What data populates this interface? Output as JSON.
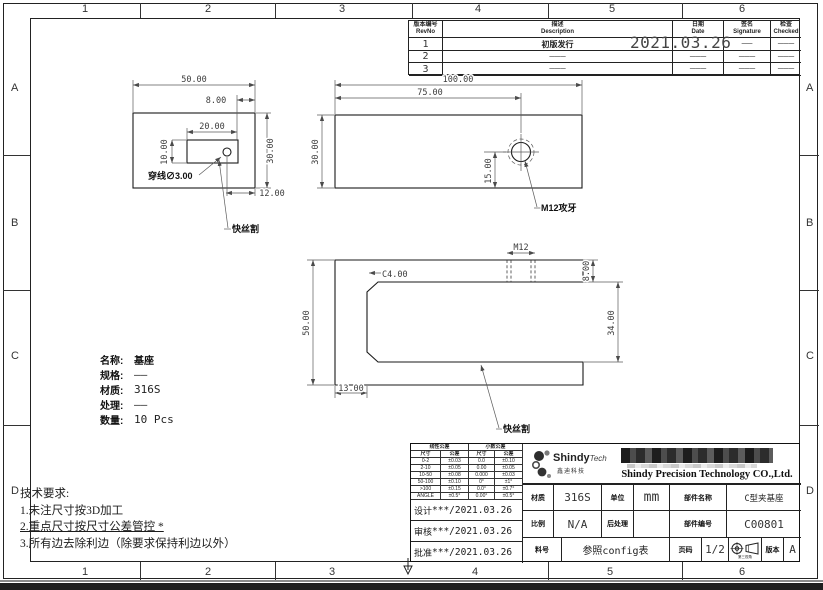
{
  "frame": {
    "columns": [
      "1",
      "2",
      "3",
      "4",
      "5",
      "6"
    ],
    "rows": [
      "A",
      "B",
      "C",
      "D"
    ]
  },
  "revision_table": {
    "headers": [
      {
        "cn": "版本编号",
        "en": "RevNo"
      },
      {
        "cn": "描述",
        "en": "Description"
      },
      {
        "cn": "日期",
        "en": "Date"
      },
      {
        "cn": "签名",
        "en": "Signature"
      },
      {
        "cn": "检查",
        "en": "Checked"
      }
    ],
    "rows": [
      {
        "no": "1",
        "desc": "初版发行",
        "date": "2021.03.26",
        "sig": "——",
        "chk": "———"
      },
      {
        "no": "2",
        "desc": "———",
        "date": "———",
        "sig": "———",
        "chk": "———"
      },
      {
        "no": "3",
        "desc": "———",
        "date": "———",
        "sig": "———",
        "chk": "———"
      }
    ]
  },
  "views": {
    "view1": {
      "dim_width": "50.00",
      "dim_8": "8.00",
      "dim_20": "20.00",
      "dim_10": "10.00",
      "dim_30": "30.00",
      "dim_12": "12.00",
      "label_hole": "穿线∅3.00",
      "label_wirecut": "快丝割"
    },
    "view2": {
      "dim_100": "100.00",
      "dim_75": "75.00",
      "dim_30": "30.00",
      "dim_15": "15.00",
      "label_tap": "M12攻牙"
    },
    "view3": {
      "dim_m12": "M12",
      "dim_c4": "C4.00",
      "dim_50": "50.00",
      "dim_13": "13.00",
      "dim_8": "8.00",
      "dim_34": "34.00",
      "label_wirecut": "快丝割"
    }
  },
  "part_info": {
    "rows": [
      {
        "label": "名称:",
        "value": "基座"
      },
      {
        "label": "规格:",
        "value": "——"
      },
      {
        "label": "材质:",
        "value": "316S"
      },
      {
        "label": "处理:",
        "value": "——"
      },
      {
        "label": "数量:",
        "value": "10 Pcs"
      }
    ]
  },
  "tech_requirements": {
    "title": "技术要求:",
    "items": [
      "1.未注尺寸按3D加工",
      "2.重点尺寸按尺寸公差管控 *",
      "3.所有边去除利边（除要求保持利边以外）"
    ]
  },
  "title_block": {
    "tolerance_table": {
      "group1": "线性公差",
      "group2": "小数公差",
      "sub_headers": [
        "尺寸",
        "公差",
        "尺寸",
        "公差"
      ],
      "rows": [
        [
          "0-2",
          "±0.03",
          "0.0",
          "±0.10"
        ],
        [
          "2-10",
          "±0.05",
          "0.00",
          "±0.05"
        ],
        [
          "10-50",
          "±0.08",
          "0.000",
          "±0.03"
        ],
        [
          "50-100",
          "±0.10",
          "0°",
          "±1°"
        ],
        [
          ">100",
          "±0.15",
          "0.0°",
          "±0.7°"
        ],
        [
          "ANGLE",
          "±0.5°",
          "0.00°",
          "±0.5°"
        ]
      ]
    },
    "signoff": [
      {
        "label": "设计",
        "value": "***/2021.03.26"
      },
      {
        "label": "审核",
        "value": "***/2021.03.26"
      },
      {
        "label": "批准",
        "value": "***/2021.03.26"
      }
    ],
    "logo": {
      "brand": "Shindy",
      "brand_suffix": "Tech",
      "brand_cn": "鑫迪科技",
      "company": "Shindy Precision Technology CO.,Ltd."
    },
    "fields": {
      "material_label": "材质",
      "material": "316S",
      "unit_label": "单位",
      "unit": "mm",
      "part_name_label": "部件名称",
      "part_name": "C型夹基座",
      "scale_label": "比例",
      "scale": "N/A",
      "post_label": "后处理",
      "post": "",
      "part_no_label": "部件编号",
      "part_no": "C00801",
      "stock_label": "料号",
      "stock": "参照config表",
      "page_label": "页码",
      "page": "1/2",
      "projection_label": "第三视角",
      "version_label": "版本",
      "version": "A"
    }
  }
}
